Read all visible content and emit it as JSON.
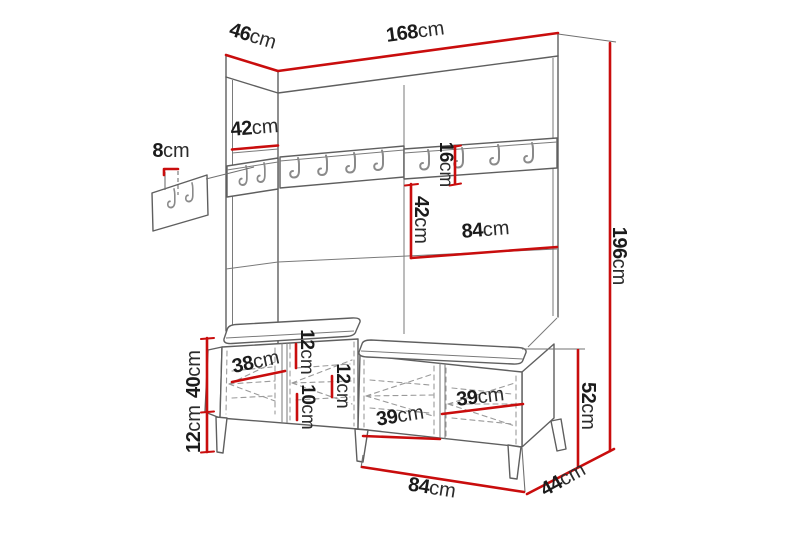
{
  "diagram": {
    "type": "furniture-dimension-diagram",
    "subject": "hallway wardrobe panel with coat hooks and shoe bench",
    "colors": {
      "dimension_red": "#c90d0d",
      "outline_gray": "#5f5f5f",
      "text": "#1b1b1b"
    },
    "dims": {
      "depth_top": {
        "num": "46",
        "unit": "cm"
      },
      "width_total": {
        "num": "168",
        "unit": "cm"
      },
      "side_panel": {
        "num": "42",
        "unit": "cm"
      },
      "hook_offset": {
        "num": "8",
        "unit": "cm"
      },
      "rail_height": {
        "num": "16",
        "unit": "cm"
      },
      "mid_panel_height": {
        "num": "42",
        "unit": "cm"
      },
      "panel_half_width": {
        "num": "84",
        "unit": "cm"
      },
      "total_height": {
        "num": "196",
        "unit": "cm"
      },
      "bench_body_height": {
        "num": "40",
        "unit": "cm"
      },
      "leg_height": {
        "num": "12",
        "unit": "cm"
      },
      "left_door_width": {
        "num": "38",
        "unit": "cm"
      },
      "shelf_gap_top": {
        "num": "12",
        "unit": "cm"
      },
      "shelf_gap_mid": {
        "num": "10",
        "unit": "cm"
      },
      "shelf_gap_right": {
        "num": "12",
        "unit": "cm"
      },
      "door_width_left": {
        "num": "39",
        "unit": "cm"
      },
      "door_width_right": {
        "num": "39",
        "unit": "cm"
      },
      "bench_total_height": {
        "num": "52",
        "unit": "cm"
      },
      "bench_module_width": {
        "num": "84",
        "unit": "cm"
      },
      "bench_depth": {
        "num": "44",
        "unit": "cm"
      }
    }
  }
}
